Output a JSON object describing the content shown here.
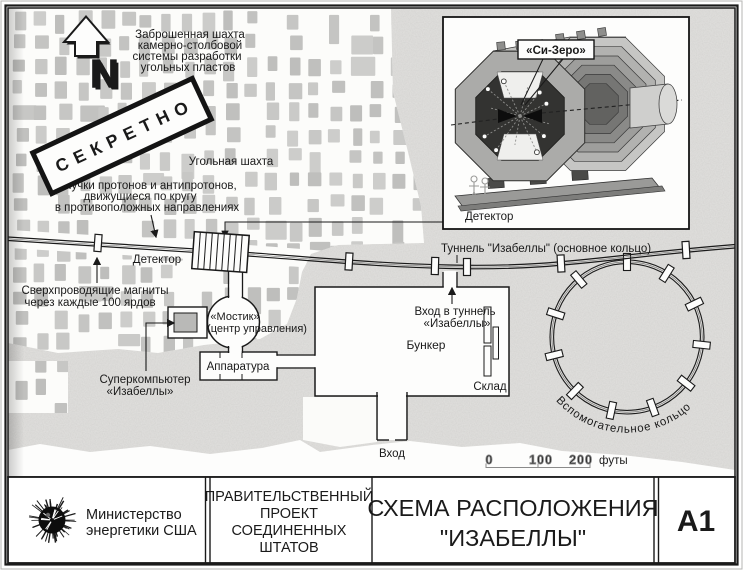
{
  "map": {
    "compass_n": "N",
    "stamp": "СЕКРЕТНО",
    "mine_note": [
      "Заброшенная шахта",
      "камерно-столбовой",
      "системы разработки",
      "угольных пластов"
    ],
    "coal_mine": "Угольная шахта",
    "beams_note": [
      "Пучки протонов и антипротонов,",
      "движущиеся по кругу",
      "в противоположных направлениях"
    ],
    "detector_label": "Детектор",
    "magnets_note": [
      "Сверхпроводящие магниты",
      "через каждые 100 ярдов"
    ],
    "supercomputer": [
      "Суперкомпьютер",
      "«Изабеллы»"
    ],
    "bridge": [
      "«Мостик»",
      "(центр управления)"
    ],
    "apparatus": "Аппаратура",
    "tunnel_label": "Туннель \"Изабеллы\" (основное кольцо)",
    "tunnel_entrance": [
      "Вход в туннель",
      "«Изабеллы»"
    ],
    "bunker": "Бункер",
    "storage": "Склад",
    "entrance": "Вход",
    "auxiliary_ring": "Вспомогательное кольцо",
    "scale": {
      "t0": "0",
      "t100": "100",
      "t200": "200",
      "unit": "футы"
    }
  },
  "inset": {
    "si_zero": "«Си-Зеро»",
    "detector": "Детектор"
  },
  "title_block": {
    "agency": [
      "Министерство",
      "энергетики США"
    ],
    "project": [
      "ПРАВИТЕЛЬСТВЕННЫЙ",
      "ПРОЕКТ",
      "СОЕДИНЕННЫХ",
      "ШТАТОВ"
    ],
    "title": [
      "СХЕМА РАСПОЛОЖЕНИЯ",
      "\"ИЗАБЕЛЛЫ\""
    ],
    "sheet": "А1"
  },
  "colors": {
    "ink": "#1a1a1a",
    "paper": "#fcfcfa",
    "rock_texture": "#e2e1df",
    "pillar": "#c6c6c4"
  }
}
